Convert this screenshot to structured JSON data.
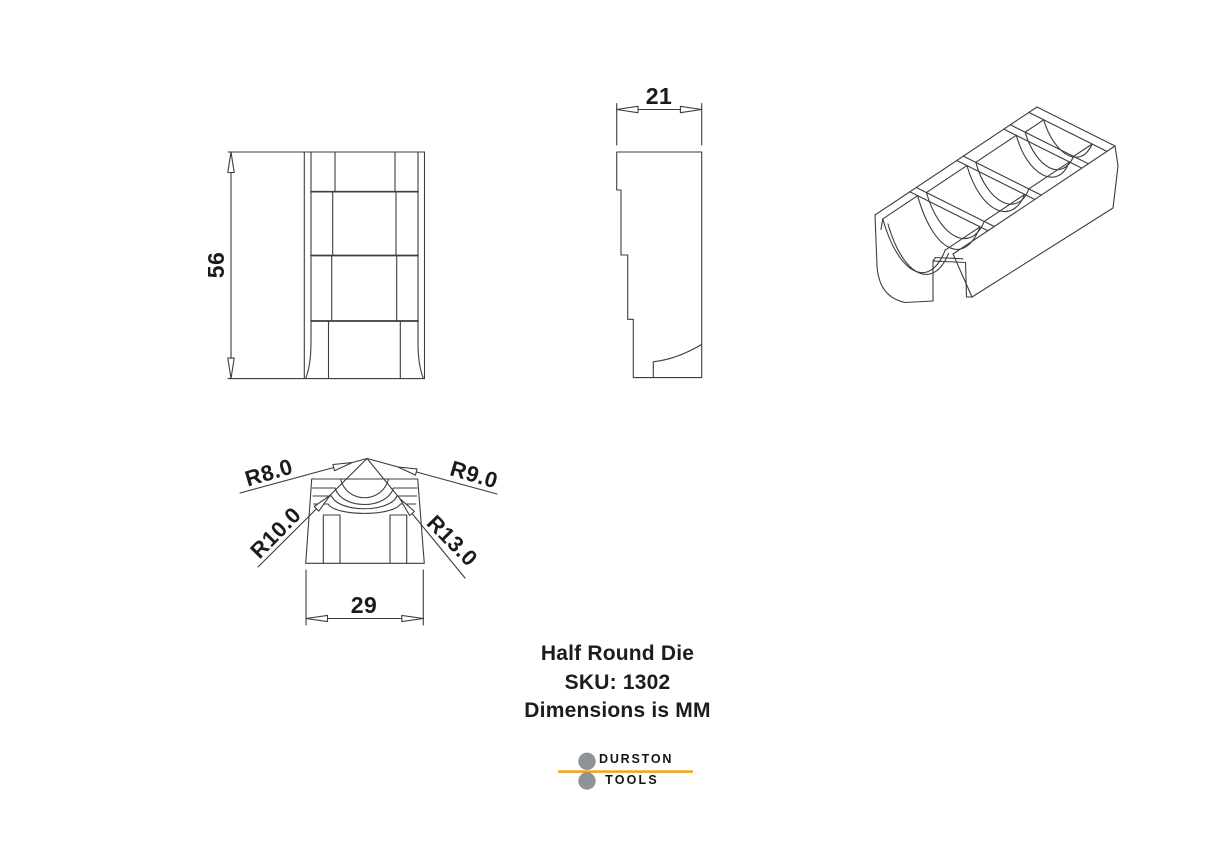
{
  "page": {
    "background": "#ffffff"
  },
  "drawing": {
    "line_color": "#3d3d3d",
    "title_block": {
      "line1": "Half Round Die",
      "line2": "SKU: 1302",
      "line3": "Dimensions is MM"
    },
    "views": {
      "front": {
        "label": "front-view",
        "height_dim": "56"
      },
      "side": {
        "label": "side-view",
        "thickness_dim": "21"
      },
      "end": {
        "label": "end-view",
        "radii": [
          "R8.0",
          "R9.0",
          "R10.0",
          "R13.0"
        ],
        "width_dim": "29"
      },
      "isometric": {
        "label": "isometric-view"
      }
    }
  },
  "logo": {
    "brand": "DURSTON",
    "sub_brand": "TOOLS",
    "accent_color": "#F5A51D",
    "roller_color": "#8F9296"
  }
}
